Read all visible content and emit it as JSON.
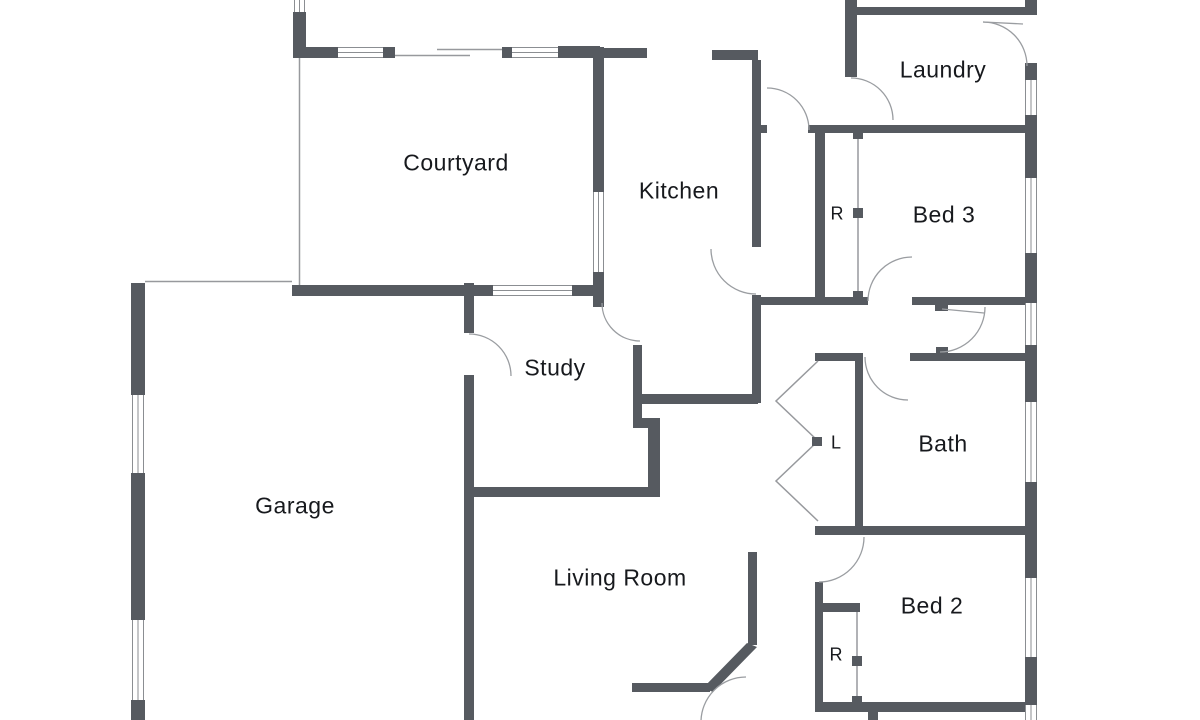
{
  "floorplan": {
    "rooms": [
      {
        "label": "Courtyard"
      },
      {
        "label": "Kitchen"
      },
      {
        "label": "Laundry"
      },
      {
        "label": "Bed 3"
      },
      {
        "label": "Study"
      },
      {
        "label": "Bath"
      },
      {
        "label": "Garage"
      },
      {
        "label": "Living Room"
      },
      {
        "label": "Bed 2"
      }
    ],
    "closets": [
      {
        "label": "R"
      },
      {
        "label": "L"
      },
      {
        "label": "R"
      }
    ],
    "colors": {
      "wall": "#565a60",
      "thin_line": "#97999d",
      "text": "#17191d",
      "background": "#ffffff"
    }
  }
}
